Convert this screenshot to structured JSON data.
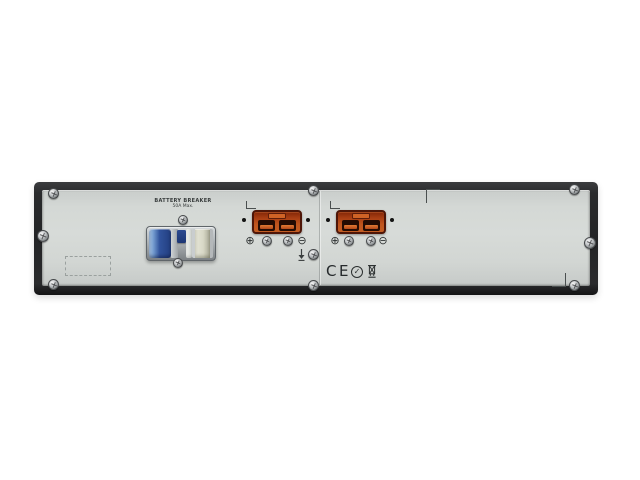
{
  "breaker": {
    "label_line1": "BATTERY BREAKER",
    "label_line2": "50A Max."
  },
  "connectors": [
    {
      "plus": "⊕",
      "minus": "⊖"
    },
    {
      "plus": "⊕",
      "minus": "⊖"
    }
  ],
  "certifications": {
    "ce_text": "CE",
    "rcm_check": "✓"
  },
  "colors": {
    "background": "#ffffff",
    "frame": "#2a2b2d",
    "panel_face": "#d3d7d4",
    "connector_orange": "#c05a1e",
    "connector_border": "#4e1608",
    "breaker_blue": "#2c4d94",
    "breaker_cream": "#ddddca"
  }
}
